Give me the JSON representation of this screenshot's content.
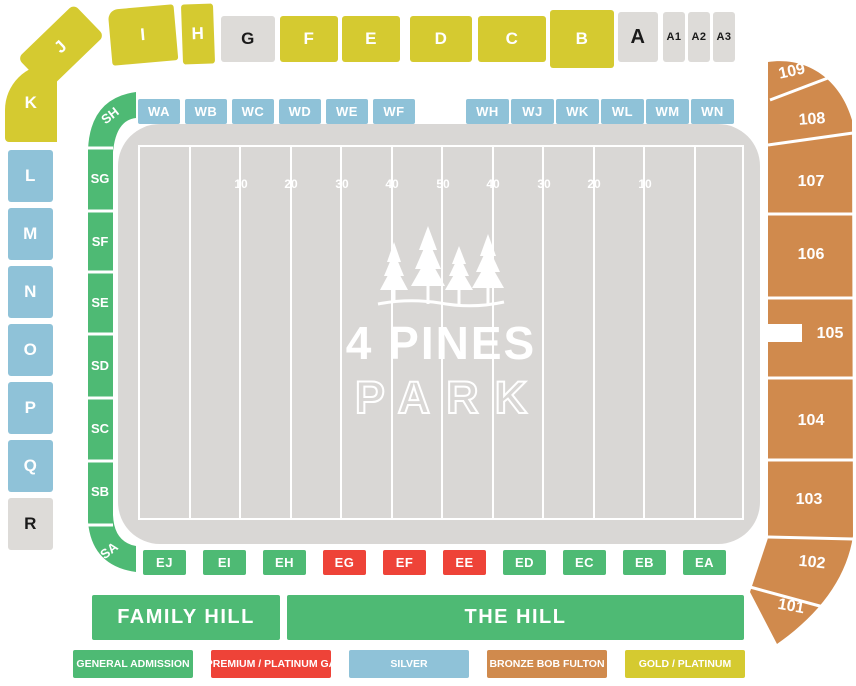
{
  "venue": {
    "brand_line1": "4 PINES",
    "brand_line2": "PARK",
    "yard_numbers": [
      "10",
      "20",
      "30",
      "40",
      "50",
      "40",
      "30",
      "20",
      "10"
    ]
  },
  "top_sections": [
    "J",
    "I",
    "H",
    "G",
    "F",
    "E",
    "D",
    "C",
    "B",
    "A",
    "A1",
    "A2",
    "A3"
  ],
  "left_sections": [
    "K",
    "L",
    "M",
    "N",
    "O",
    "P",
    "Q",
    "R"
  ],
  "west_row": [
    "WA",
    "WB",
    "WC",
    "WD",
    "WE",
    "WF",
    "WH",
    "WJ",
    "WK",
    "WL",
    "WM",
    "WN"
  ],
  "s_row": [
    "SH",
    "SG",
    "SF",
    "SE",
    "SD",
    "SC",
    "SB",
    "SA"
  ],
  "e_row": [
    "EJ",
    "EI",
    "EH",
    "EG",
    "EF",
    "EE",
    "ED",
    "EC",
    "EB",
    "EA"
  ],
  "right_sections": [
    "109",
    "108",
    "107",
    "106",
    "105",
    "104",
    "103",
    "102",
    "101"
  ],
  "hills": [
    "FAMILY HILL",
    "THE HILL"
  ],
  "legend": [
    {
      "label": "GENERAL ADMISSION",
      "tier": "ga"
    },
    {
      "label": "PREMIUM / PLATINUM GA",
      "tier": "premium"
    },
    {
      "label": "SILVER",
      "tier": "silver"
    },
    {
      "label": "BRONZE BOB FULTON",
      "tier": "bronze"
    },
    {
      "label": "GOLD / PLATINUM",
      "tier": "gold"
    }
  ],
  "colors": {
    "gold": "#d5ca30",
    "silver": "#8fc2d8",
    "ga": "#4eba74",
    "premium": "#ee4338",
    "bronze": "#d08a4d",
    "neutral": "#dddbd8",
    "field": "#d9d7d5"
  }
}
